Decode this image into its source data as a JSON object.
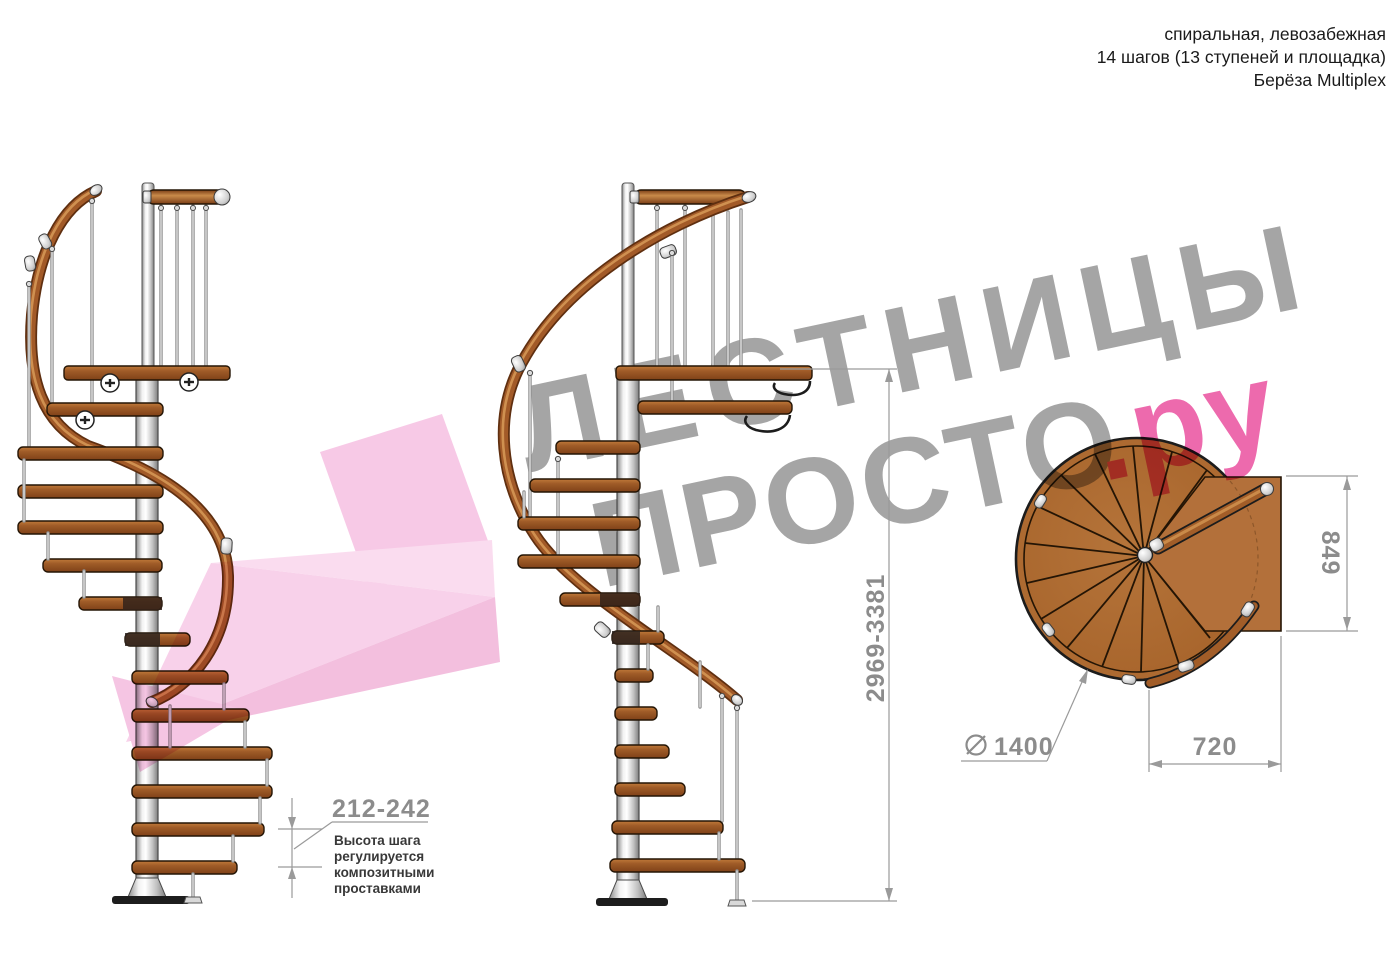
{
  "header": {
    "line1": "спиральная, левозабежная",
    "line2": "14 шагов (13 ступеней и площадка)",
    "line3": "Берёза Multiplex"
  },
  "watermark": {
    "word1": "ЛЕСТНИЦЫ",
    "word2": "ПРОСТО",
    "suffix": ".ру"
  },
  "dimensions": {
    "step_height_range": "212-242",
    "note_lines": [
      "Высота шага",
      "регулируется",
      "композитными",
      "проставками"
    ],
    "total_height_range": "2969-3381",
    "landing_side": "849",
    "landing_width": "720",
    "diameter_value": "1400"
  },
  "colors": {
    "accent_pink": "#ec5da6",
    "arrow_pink": "#f3b5db",
    "watermark_gray": "#9d9d9d",
    "dimension_gray": "#8c8c8c",
    "wood_brown": "#a86229",
    "pole_silver": "#c9c9c9"
  }
}
